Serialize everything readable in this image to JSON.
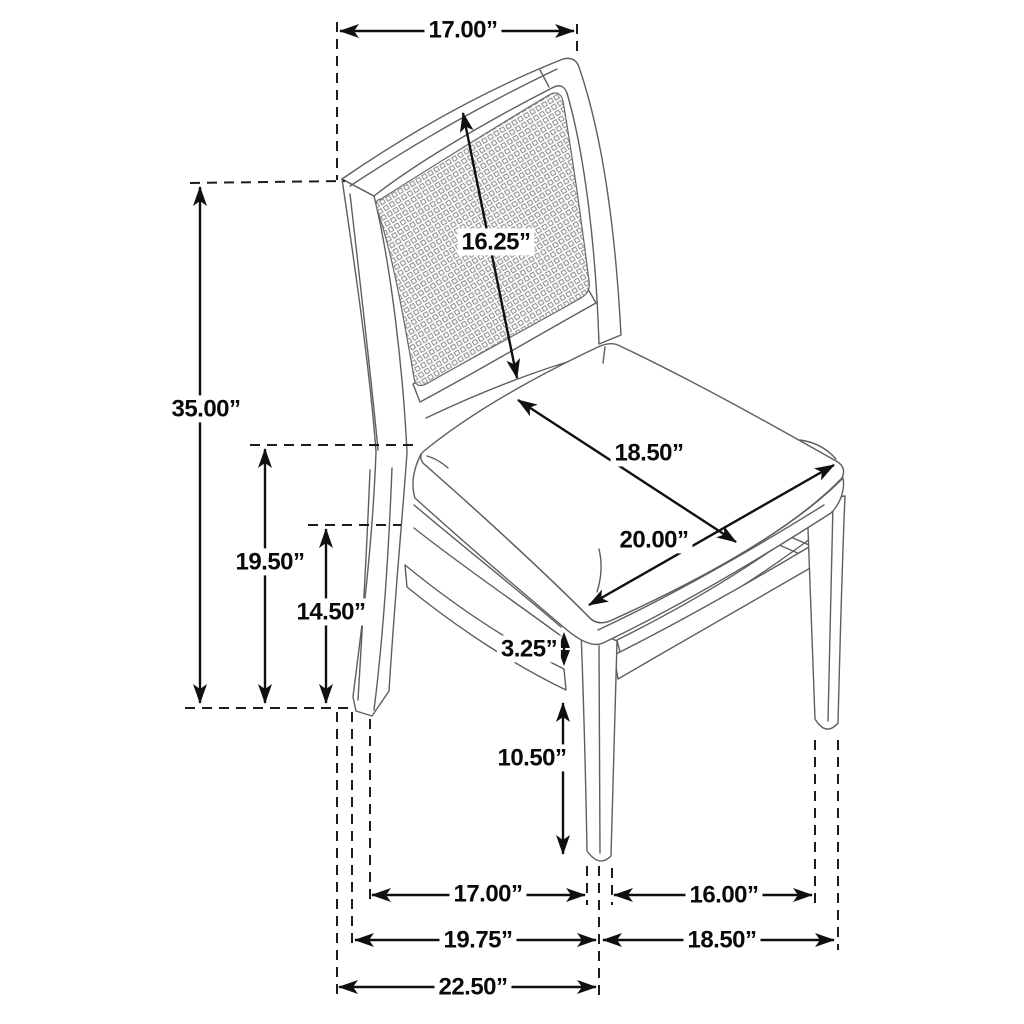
{
  "diagram": {
    "name": "chair-dimensions-diagram",
    "unit": "inches",
    "dimensions": {
      "back_top_width": "17.00”",
      "backrest_diagonal_height": "16.25”",
      "overall_height": "35.00”",
      "seat_height": "19.50”",
      "floor_to_apron": "14.50”",
      "seat_depth": "18.50”",
      "seat_width": "20.00”",
      "apron_to_stretcher_gap": "3.25”",
      "front_leg_height": "10.50”",
      "floor_depth_back_to_front_leg": "17.00”",
      "floor_width_between_front_legs": "16.00”",
      "floor_depth_outer_left": "19.75”",
      "floor_width_outer_right": "18.50”",
      "overall_depth": "22.50”"
    }
  }
}
